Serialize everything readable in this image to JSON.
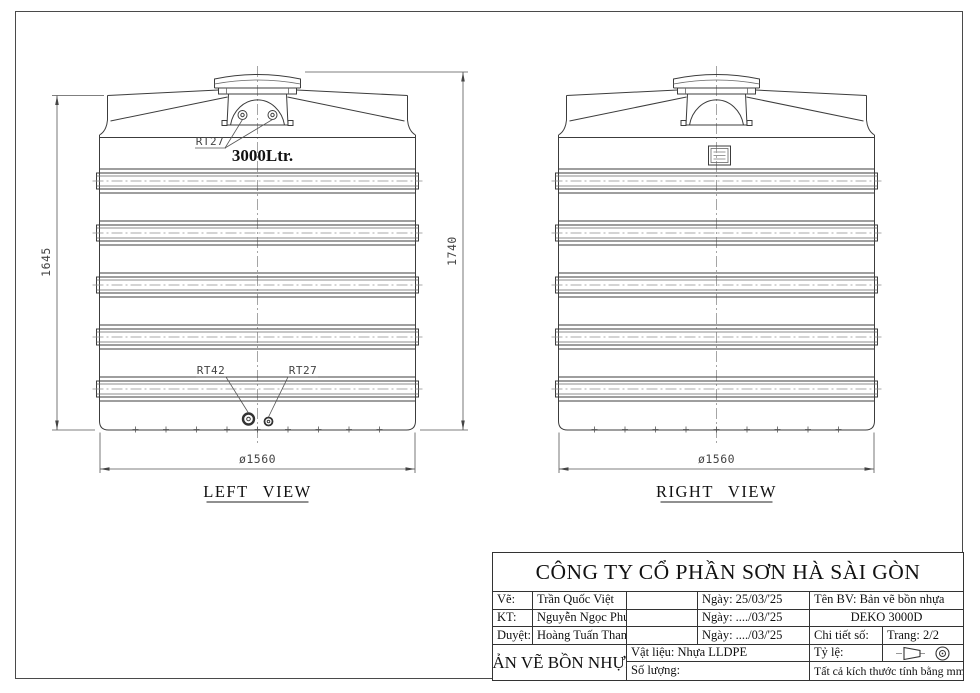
{
  "views": {
    "left": {
      "title": "LEFT VIEW"
    },
    "right": {
      "title": "RIGHT VIEW"
    }
  },
  "dims": {
    "height_body": "1645",
    "height_total": "1740",
    "diameter": "ø1560"
  },
  "labels": {
    "capacity": "3000Ltr.",
    "top_ports": "RT27",
    "bottom_large": "RT42",
    "bottom_small": "RT27"
  },
  "title_block": {
    "company": "CÔNG TY CỔ PHẦN SƠN HÀ SÀI GÒN",
    "drawn_label": "Vẽ:",
    "drawn_name": "Trần Quốc Việt",
    "drawn_date": "Ngày: 25/03/'25",
    "checked_label": "KT:",
    "checked_name": "Nguyễn Ngọc Phú",
    "checked_date": "Ngày: ..../03/'25",
    "approved_label": "Duyệt:",
    "approved_name": "Hoàng Tuấn Thanh",
    "approved_date": "Ngày: ..../03/'25",
    "drawing_name": "Tên BV: Bản vẽ bồn nhựa",
    "model": "DEKO 3000D",
    "detail_no_label": "Chi tiết số:",
    "page_label": "Trang: 2/2",
    "doc_title": "BẢN VẼ BỒN NHỰA",
    "material_label": "Vật liệu: Nhựa LLDPE",
    "scale_label": "Tỷ lệ:",
    "quantity_label": "Số lượng:",
    "units_note": "Tất cả kích thước tính bằng mm",
    "icons": [
      "projection-cone-icon",
      "projection-circles-icon"
    ]
  }
}
